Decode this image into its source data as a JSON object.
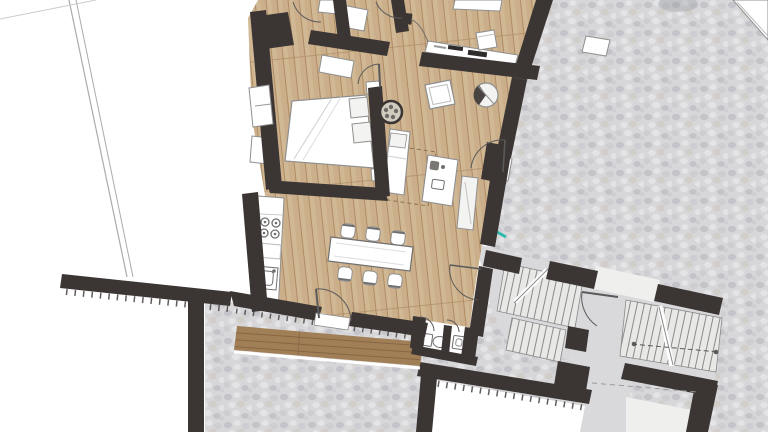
{
  "meta": {
    "title": "Apartment floor plan – top view rendering",
    "view": "2D architectural plan with furniture, surrounding cobblestone courtyard and shared stairwell",
    "canvas": {
      "width_px": 768,
      "height_px": 432
    }
  },
  "aria": {
    "plan_label": "Rendered floor plan of an apartment with bedroom, living room, kitchen and dining area, office nook, WC, entry deck, neighbouring buildings, cobblestone courtyard and a stairwell with two flights of stairs"
  },
  "colors": {
    "background": "#ffffff",
    "wall": "#3b3534",
    "wall_edge": "#2a2524",
    "wood_floor": "#cbae8a",
    "wood_floor_light": "#d9c3a2",
    "wood_floor_line": "#ae8c64",
    "deck": "#a07e56",
    "deck_line": "#876643",
    "cobble_base": "#d7d7d9",
    "cobble_dark": "#c3c3c9",
    "cobble_mid": "#cdcdd2",
    "cobble_light": "#e4e4e6",
    "cobble_warm": "#d1cec9",
    "stair_floor": "#d9d9db",
    "stair_landing": "#efefee",
    "stair_step": "#e8e8e7",
    "stair_line": "#8a8a8a",
    "furniture_fill": "#ffffff",
    "furniture_soft": "#f3f3f1",
    "furniture_outline": "#8f8f8f",
    "fixture_outline": "#6f6f6f",
    "door_arc": "#5a5a5a",
    "dashed_brown": "#8a7354",
    "dashed_gray": "#9a9a9a",
    "neighbor_line": "#ababab",
    "ornament_ring": "#3b3534",
    "ornament_fill": "#d2cbc0",
    "bowl_dark": "#4a4441",
    "desk_item_dark": "#2f2b2a",
    "teal_accent": "#2fb8ad",
    "shadow_soft": "#8a8f96"
  },
  "scene": {
    "rooms": [
      {
        "name": "bedroom",
        "furniture": [
          "double-bed",
          "two-pillows",
          "folded-duvet",
          "nightstand",
          "nightstand"
        ]
      },
      {
        "name": "living-room",
        "furniture": [
          "daybed-chaise",
          "side-desk",
          "round-ornament-table",
          "wall-bench"
        ]
      },
      {
        "name": "kitchen-dining",
        "furniture": [
          "kitchen-counter",
          "cooktop",
          "sink",
          "dining-table",
          "dining-chairs"
        ]
      },
      {
        "name": "office-nook",
        "furniture": [
          "long-desk",
          "desk-chair",
          "wall-table",
          "picture-frame",
          "round-bowl"
        ]
      },
      {
        "name": "wc",
        "furniture": [
          "toilet",
          "hand-basin"
        ]
      },
      {
        "name": "entry-deck",
        "furniture": []
      },
      {
        "name": "stair-hall",
        "furniture": [
          "stair-flight-upper",
          "stair-flight-lower",
          "stair-flight-right"
        ]
      },
      {
        "name": "courtyard",
        "furniture": [
          "stone-block"
        ]
      }
    ],
    "counts": {
      "dining_chairs": 6,
      "cooktop_burners": 4,
      "door_swings": 9,
      "stair_flights": 3,
      "windows_in_walls": 2
    },
    "materials": {
      "apartment_floor": "light oak plank",
      "entry_deck": "dark timber plank",
      "courtyard": "cobblestone",
      "stair_hall": "smooth screed"
    }
  }
}
